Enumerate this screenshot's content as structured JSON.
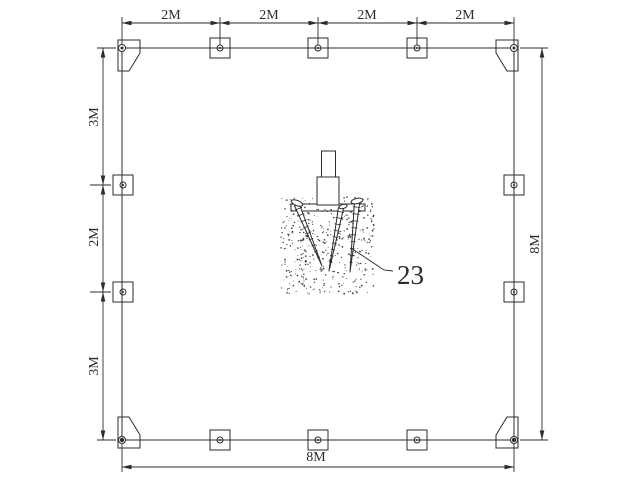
{
  "diagram": {
    "top_dimensions": [
      "2M",
      "2M",
      "2M",
      "2M"
    ],
    "left_dimensions": [
      "3M",
      "2M",
      "3M"
    ],
    "right_dimension": "8M",
    "bottom_dimension": "8M",
    "callout": "23"
  },
  "colors": {
    "line": "#2b2b2b",
    "background": "#ffffff"
  }
}
